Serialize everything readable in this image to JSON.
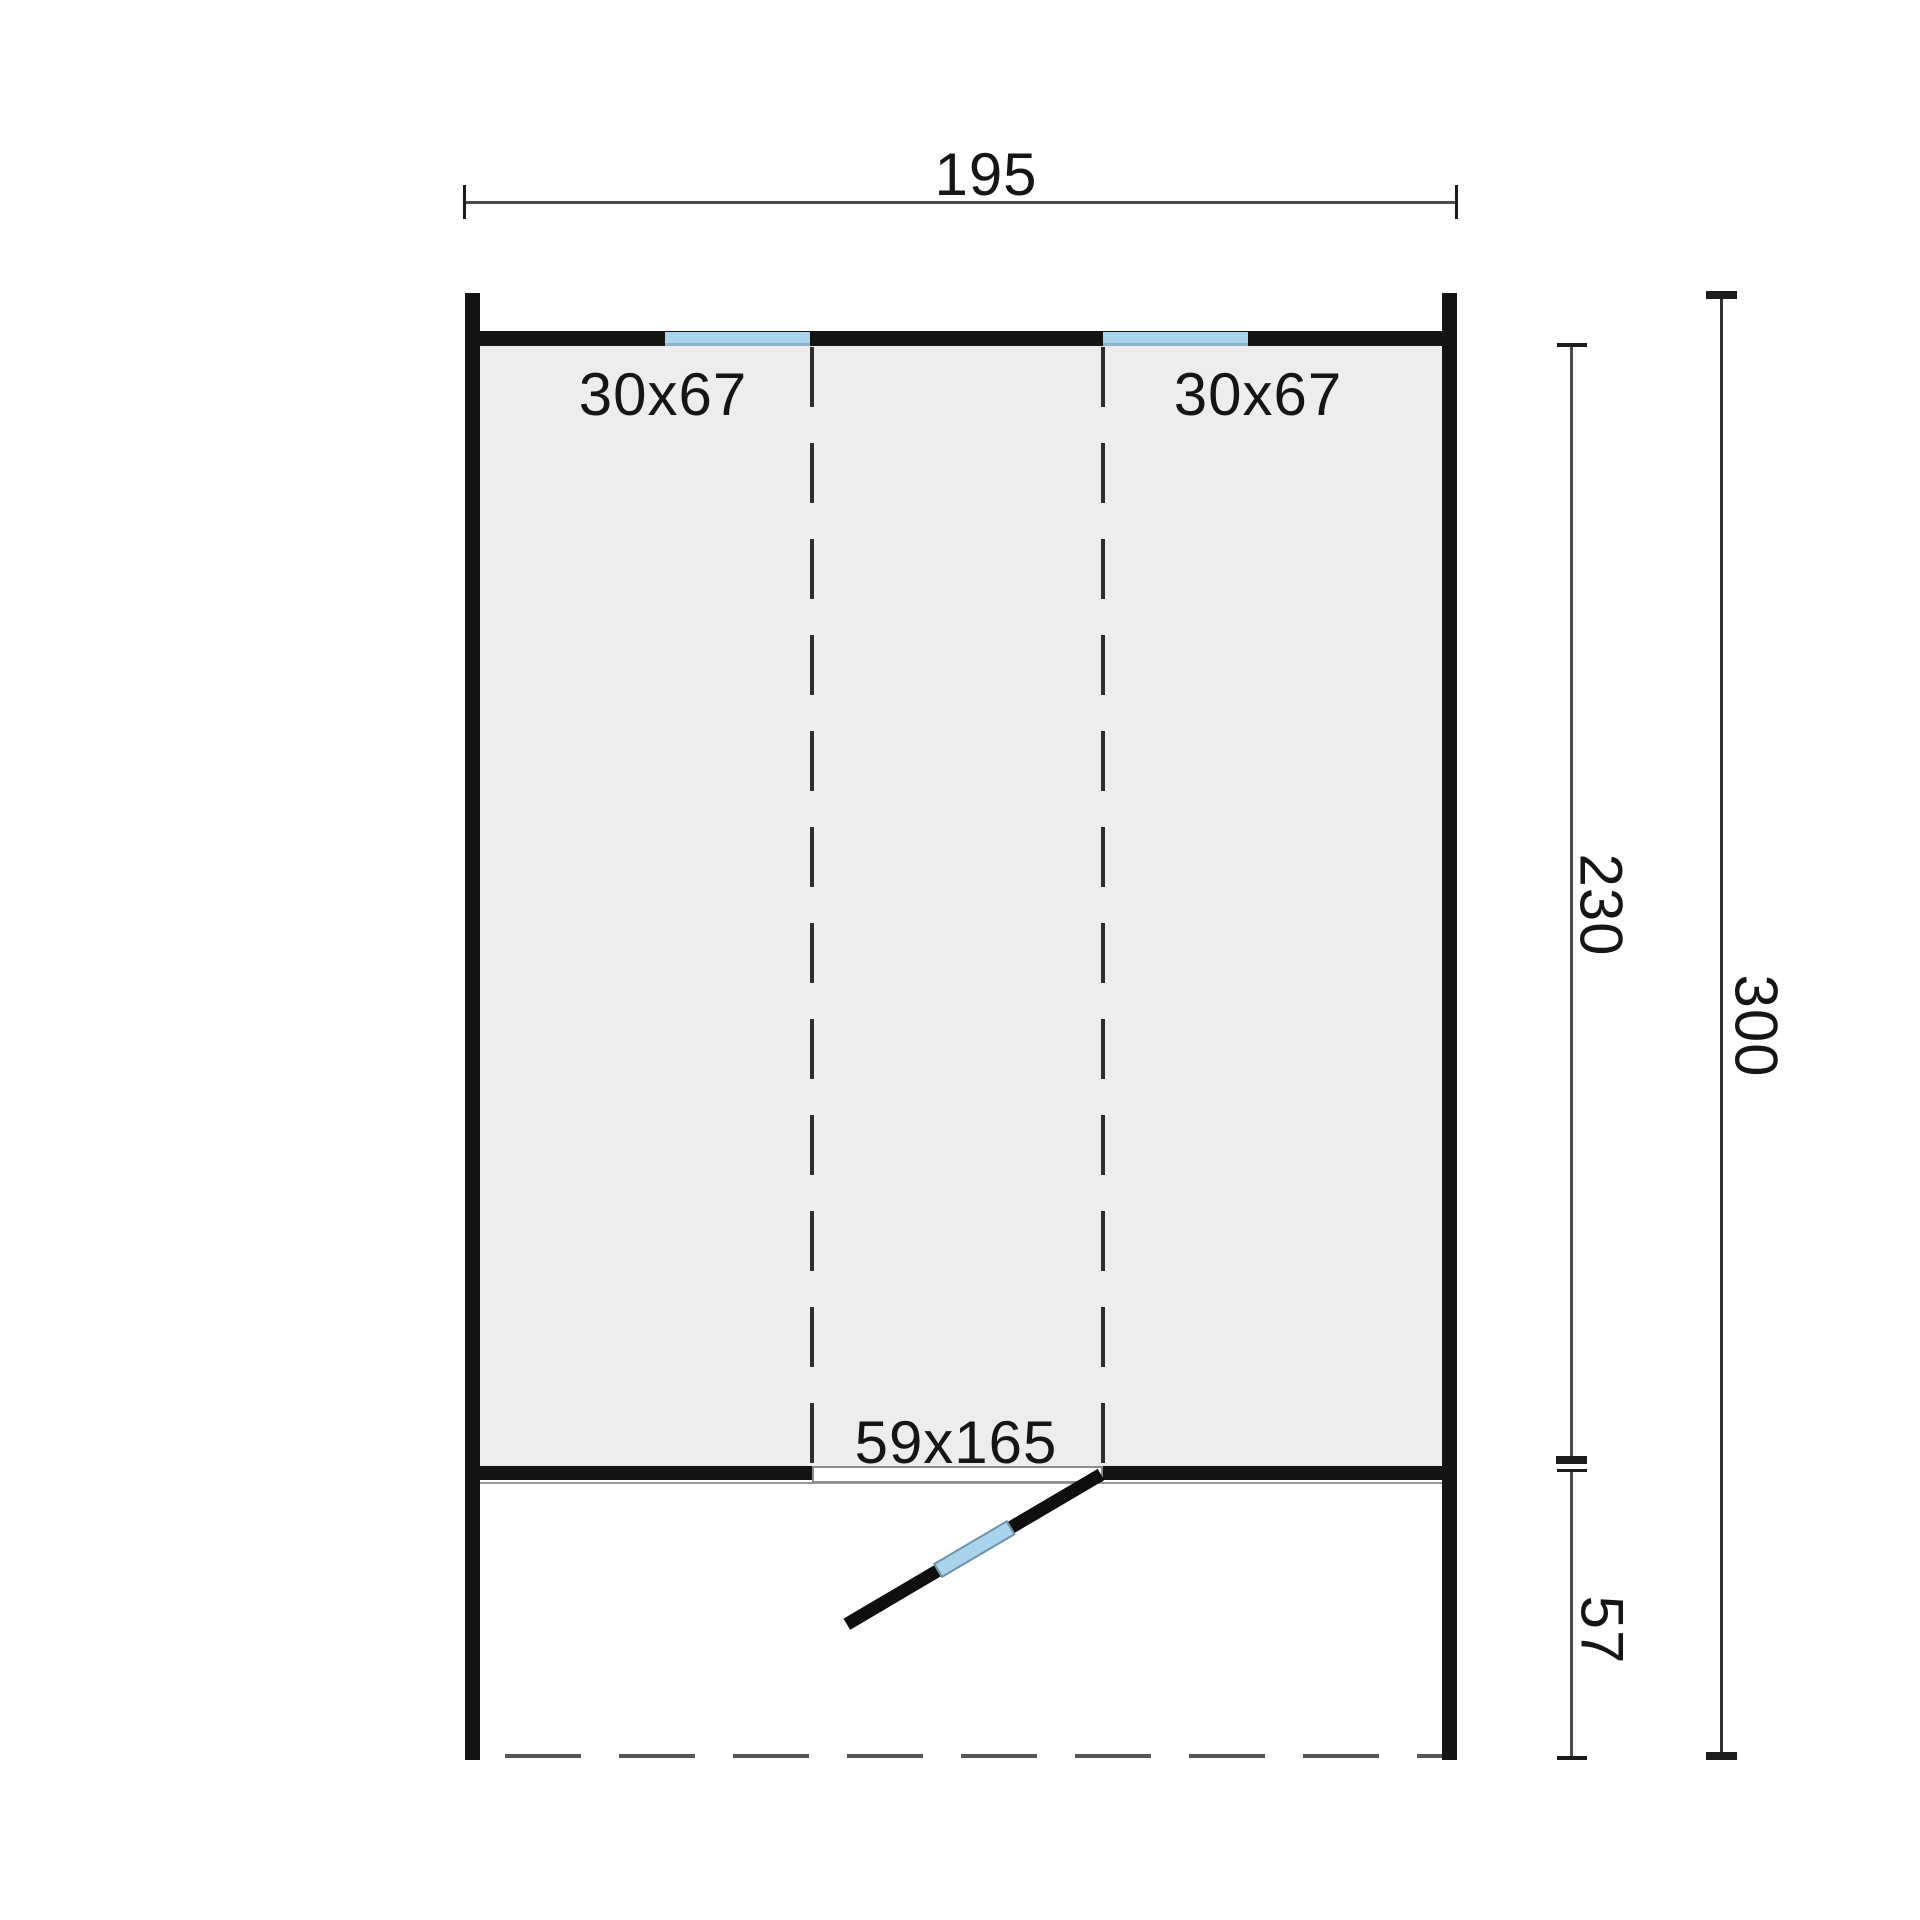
{
  "plan": {
    "type": "cabin-floor-plan",
    "dimensions": {
      "width_cm": "195",
      "inner_depth_cm": "230",
      "total_depth_cm": "300",
      "porch_depth_cm": "57"
    },
    "openings": {
      "window_left": "30x67",
      "window_right": "30x67",
      "door": "59x165"
    },
    "colors": {
      "wall": "#141414",
      "floor_fill": "#ededed",
      "window_blue": "#a9d4ec",
      "window_edge": "#8fb3c9",
      "dimension_line": "#4b4b4b",
      "dashed_line": "#2e2e2e",
      "text": "#151515",
      "background": "#ffffff"
    }
  }
}
